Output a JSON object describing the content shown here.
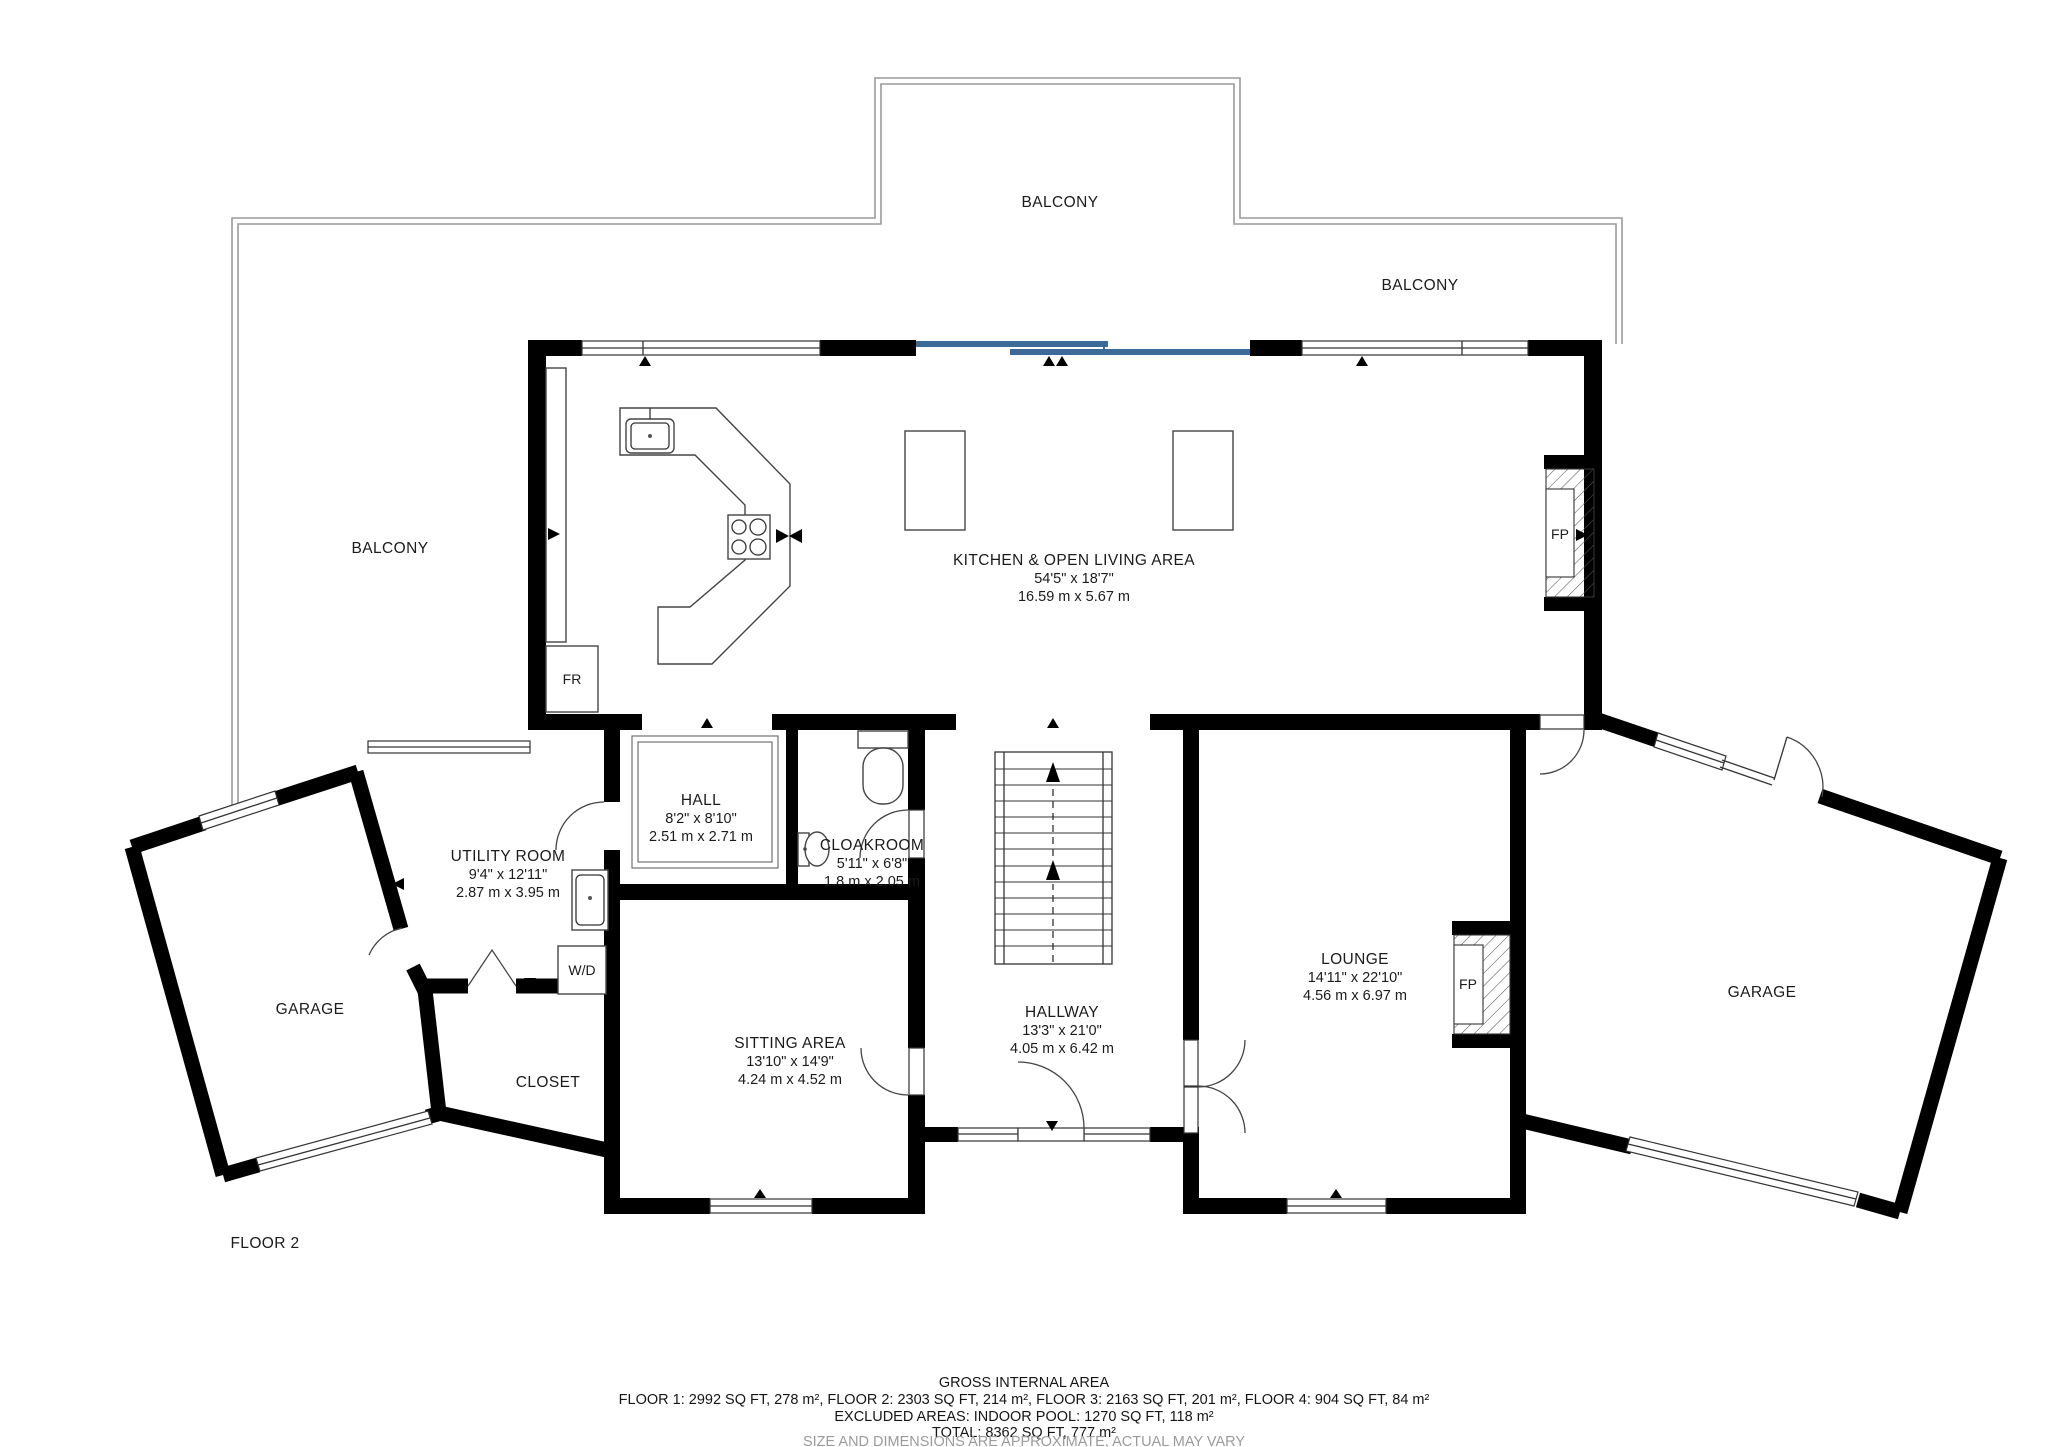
{
  "floor_label": "FLOOR 2",
  "balconies": {
    "left": "BALCONY",
    "top": "BALCONY",
    "right": "BALCONY"
  },
  "rooms": {
    "kitchen": {
      "name": "KITCHEN & OPEN LIVING AREA",
      "imperial": "54'5\" x 18'7\"",
      "metric": "16.59 m x 5.67 m"
    },
    "hall": {
      "name": "HALL",
      "imperial": "8'2\" x 8'10\"",
      "metric": "2.51 m x 2.71 m"
    },
    "cloakroom": {
      "name": "CLOAKROOM",
      "imperial": "5'11\" x 6'8\"",
      "metric": "1.8 m x 2.05 m"
    },
    "utility_room": {
      "name": "UTILITY ROOM",
      "imperial": "9'4\" x 12'11\"",
      "metric": "2.87 m x 3.95 m"
    },
    "sitting_area": {
      "name": "SITTING AREA",
      "imperial": "13'10\" x 14'9\"",
      "metric": "4.24 m x 4.52 m"
    },
    "hallway": {
      "name": "HALLWAY",
      "imperial": "13'3\" x 21'0\"",
      "metric": "4.05 m x 6.42 m"
    },
    "lounge": {
      "name": "LOUNGE",
      "imperial": "14'11\" x 22'10\"",
      "metric": "4.56 m x 6.97 m"
    },
    "garage_left": {
      "name": "GARAGE"
    },
    "garage_right": {
      "name": "GARAGE"
    },
    "closet": {
      "name": "CLOSET"
    }
  },
  "fixtures": {
    "fireplace_kitchen": "FP",
    "fireplace_lounge": "FP",
    "fridge": "FR",
    "washer_dryer": "W/D"
  },
  "footer": {
    "line1": "GROSS INTERNAL AREA",
    "line2": "FLOOR 1: 2992 SQ FT, 278 m², FLOOR 2: 2303 SQ FT, 214 m², FLOOR 3: 2163 SQ FT, 201 m², FLOOR 4: 904 SQ FT, 84 m²",
    "line3": "EXCLUDED AREAS: INDOOR POOL: 1270 SQ FT, 118 m²",
    "line4": "TOTAL: 8362 SQ FT, 777 m²",
    "line5": "SIZE AND DIMENSIONS ARE APPROXIMATE, ACTUAL MAY VARY"
  },
  "colors": {
    "wall": "#000000",
    "sliding_door": "#3d6b99",
    "balcony_line": "#9a9a9a",
    "muted_text": "#9b9b9b"
  }
}
